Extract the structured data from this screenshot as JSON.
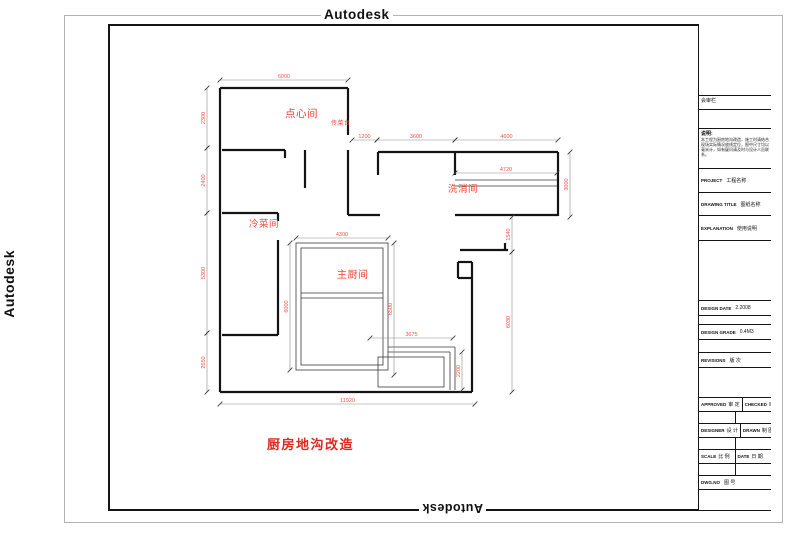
{
  "watermarks": {
    "top": "Autodesk",
    "left": "Autodesk",
    "bottom": "Autodesk"
  },
  "plan": {
    "title": "厨房地沟改造",
    "wall_color": "#141414",
    "thin_color": "#3a3a3a",
    "dim_line_color": "#8c8c8c",
    "dim_tick_color": "#3c3c3c",
    "dim_text_color": "#f2564a",
    "label_color": "#ee4335",
    "rooms": [
      {
        "t": "点心间",
        "x": 285,
        "y": 117,
        "fs": 10.5
      },
      {
        "t": "传菜台",
        "x": 331,
        "y": 125,
        "fs": 6
      },
      {
        "t": "洗消间",
        "x": 448,
        "y": 192,
        "fs": 9.5
      },
      {
        "t": "冷菜间",
        "x": 249,
        "y": 227,
        "fs": 9.5
      },
      {
        "t": "主厨间",
        "x": 337,
        "y": 278,
        "fs": 10
      }
    ],
    "walls": [
      [
        220,
        88,
        348,
        88
      ],
      [
        220,
        88,
        220,
        392
      ],
      [
        348,
        88,
        348,
        135
      ],
      [
        348,
        150,
        348,
        215
      ],
      [
        222,
        150,
        285,
        150
      ],
      [
        285,
        150,
        285,
        158
      ],
      [
        305,
        150,
        305,
        188
      ],
      [
        222,
        213,
        278,
        213
      ],
      [
        278,
        213,
        278,
        221
      ],
      [
        278,
        240,
        278,
        335
      ],
      [
        222,
        335,
        278,
        335
      ],
      [
        220,
        392,
        472,
        392
      ],
      [
        472,
        262,
        472,
        392
      ],
      [
        458,
        262,
        472,
        262
      ],
      [
        458,
        262,
        458,
        278
      ],
      [
        458,
        278,
        472,
        278
      ],
      [
        378,
        152,
        558,
        152
      ],
      [
        378,
        152,
        378,
        175
      ],
      [
        455,
        152,
        455,
        175
      ],
      [
        558,
        152,
        558,
        216
      ],
      [
        348,
        215,
        380,
        215
      ],
      [
        455,
        215,
        558,
        215
      ],
      [
        460,
        250,
        508,
        250
      ],
      [
        505,
        243,
        505,
        250
      ]
    ],
    "thin_lines": [
      [
        301,
        293,
        383,
        293
      ],
      [
        301,
        298,
        383,
        298
      ],
      [
        388,
        347,
        455,
        347
      ],
      [
        388,
        352,
        450,
        352
      ],
      [
        450,
        352,
        450,
        390
      ],
      [
        455,
        347,
        455,
        390
      ],
      [
        455,
        180,
        557,
        180
      ],
      [
        455,
        186,
        557,
        186
      ]
    ],
    "thin_rects": [
      [
        296,
        243,
        92,
        127
      ],
      [
        301,
        248,
        82,
        117
      ],
      [
        378,
        357,
        66,
        30
      ]
    ],
    "dims": [
      {
        "v": "6000",
        "o": "h",
        "a": 220,
        "b": 348,
        "p": 80
      },
      {
        "v": "1200",
        "o": "h",
        "a": 352,
        "b": 377,
        "p": 140
      },
      {
        "v": "3600",
        "o": "h",
        "a": 377,
        "b": 455,
        "p": 140
      },
      {
        "v": "4600",
        "o": "h",
        "a": 455,
        "b": 558,
        "p": 140
      },
      {
        "v": "4720",
        "o": "h",
        "a": 455,
        "b": 557,
        "p": 173
      },
      {
        "v": "4300",
        "o": "h",
        "a": 296,
        "b": 388,
        "p": 238
      },
      {
        "v": "3675",
        "o": "h",
        "a": 370,
        "b": 453,
        "p": 338
      },
      {
        "v": "11920",
        "o": "h",
        "a": 220,
        "b": 475,
        "p": 404
      },
      {
        "v": "2300",
        "o": "v",
        "a": 88,
        "b": 148,
        "p": 207
      },
      {
        "v": "2400",
        "o": "v",
        "a": 148,
        "b": 213,
        "p": 207
      },
      {
        "v": "5300",
        "o": "v",
        "a": 213,
        "b": 333,
        "p": 207
      },
      {
        "v": "2650",
        "o": "v",
        "a": 333,
        "b": 392,
        "p": 207
      },
      {
        "v": "3000",
        "o": "v",
        "a": 152,
        "b": 217,
        "p": 570
      },
      {
        "v": "1540",
        "o": "v",
        "a": 217,
        "b": 252,
        "p": 512
      },
      {
        "v": "6030",
        "o": "v",
        "a": 252,
        "b": 392,
        "p": 512
      },
      {
        "v": "6000",
        "o": "v",
        "a": 243,
        "b": 370,
        "p": 290
      },
      {
        "v": "6500",
        "o": "v",
        "a": 243,
        "b": 375,
        "p": 394
      },
      {
        "v": "2200",
        "o": "v",
        "a": 352,
        "b": 390,
        "p": 462
      }
    ]
  },
  "titleblock": {
    "rows": [
      {
        "type": "logo",
        "h": 72,
        "name": "logo-box"
      },
      {
        "type": "label",
        "h": 14,
        "text": "会审栏",
        "name": "review-column-cell"
      },
      {
        "type": "empty",
        "h": 19,
        "name": "empty-cell"
      },
      {
        "type": "notes",
        "h": 40,
        "head": "说明:",
        "body": "本工程为厨房地沟改造，施工时请结合现场实际情况放线定位，图中尺寸均以毫米计，如有疑问请及时与设计人员联系。",
        "name": "notes-cell"
      },
      {
        "type": "field",
        "h": 24,
        "en": "PROJECT",
        "cn": "工程名称",
        "name": "project-field"
      },
      {
        "type": "field",
        "h": 23,
        "en": "DRAWING TITLE",
        "cn": "图纸名称",
        "name": "drawing-title-field"
      },
      {
        "type": "field",
        "h": 25,
        "en": "EXPLANATION",
        "cn": "使用说明",
        "name": "explanation-field"
      },
      {
        "type": "empty",
        "h": 60,
        "name": "empty-cell"
      },
      {
        "type": "field",
        "h": 15,
        "en": "DESIGN DATE",
        "cn": "2.2008",
        "name": "design-date-field"
      },
      {
        "type": "empty",
        "h": 9,
        "name": "empty-cell"
      },
      {
        "type": "field",
        "h": 15,
        "en": "DESIGN GRADE",
        "cn": "0.4M3",
        "name": "design-grade-field"
      },
      {
        "type": "empty",
        "h": 13,
        "name": "empty-cell"
      },
      {
        "type": "field",
        "h": 15,
        "en": "REVISIONS",
        "cn": "版 次",
        "name": "revisions-field"
      },
      {
        "type": "empty",
        "h": 30,
        "name": "empty-cell"
      },
      {
        "type": "pair",
        "h": 14,
        "cells": [
          {
            "en": "APPROVED",
            "cn": "审 定"
          },
          {
            "en": "CHECKED",
            "cn": "审 核"
          }
        ],
        "name": "approved-checked-row"
      },
      {
        "type": "pair",
        "h": 12,
        "cells": [
          {},
          {}
        ],
        "name": "empty-pair-row"
      },
      {
        "type": "pair",
        "h": 14,
        "cells": [
          {
            "en": "DESIGNER",
            "cn": "设 计"
          },
          {
            "en": "DRAWN",
            "cn": "制 图"
          }
        ],
        "name": "designer-drawn-row"
      },
      {
        "type": "pair",
        "h": 12,
        "cells": [
          {},
          {}
        ],
        "name": "empty-pair-row"
      },
      {
        "type": "pair",
        "h": 14,
        "cells": [
          {
            "en": "SCALE",
            "cn": "比 例"
          },
          {
            "en": "DATE",
            "cn": "日 期"
          }
        ],
        "name": "scale-date-row"
      },
      {
        "type": "pair",
        "h": 12,
        "cells": [
          {},
          {}
        ],
        "name": "empty-pair-row"
      },
      {
        "type": "field",
        "h": 14,
        "en": "DWG.NO",
        "cn": "图 号",
        "name": "dwg-no-field"
      },
      {
        "type": "empty",
        "h": 21,
        "name": "empty-cell"
      }
    ]
  }
}
